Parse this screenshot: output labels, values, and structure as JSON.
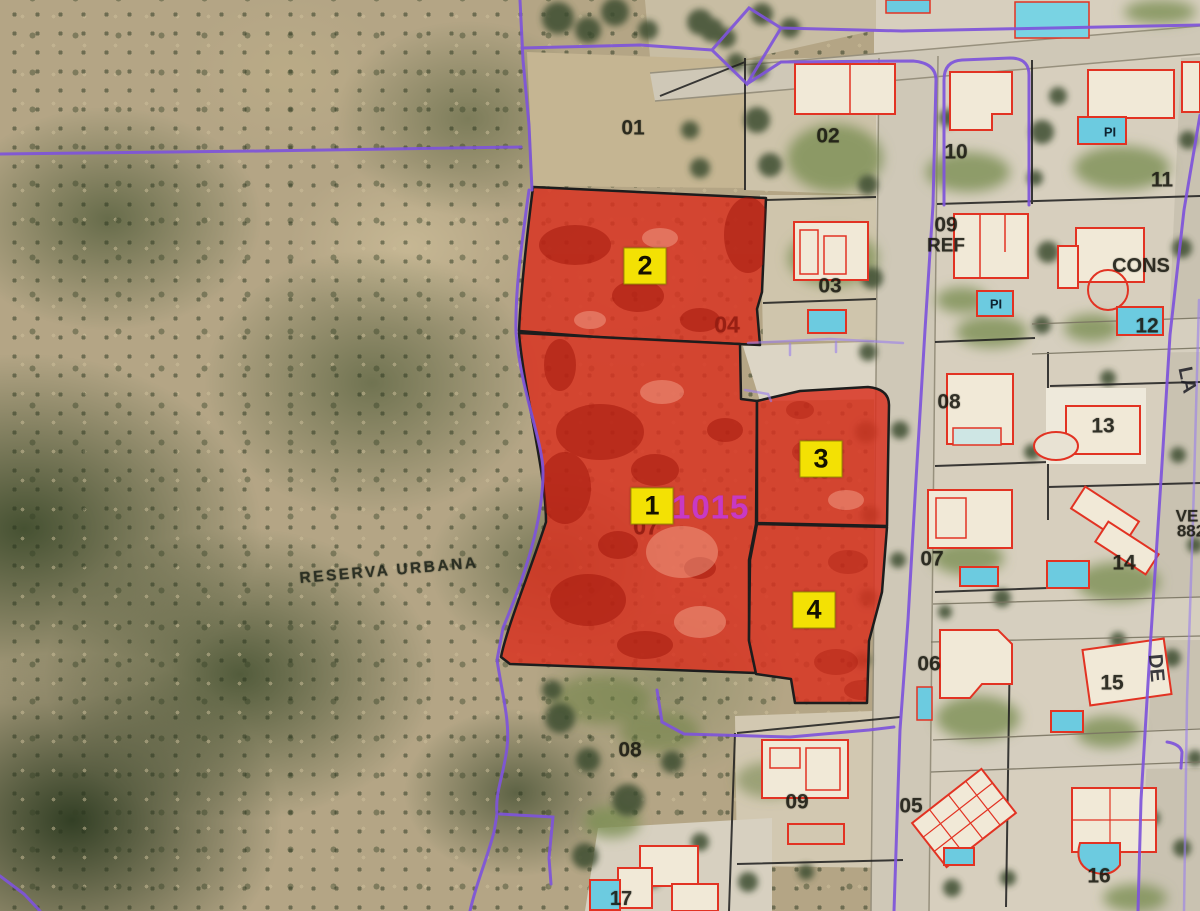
{
  "map": {
    "description": "Aerial cadastral map with red highlighted parcels",
    "colors": {
      "highlight_fill": "#d43322",
      "badge_bg": "#f2e10c",
      "boundary_purple": "#7d55d6",
      "building_outline": "#dd3425",
      "ref_magenta": "#c43bbf",
      "sub_label_dark_red": "#8e1d12"
    },
    "area_label": {
      "text": "RESERVA URBANA",
      "x": 389,
      "y": 571,
      "rotation": -5
    },
    "ref_label": {
      "text": "31015",
      "x": 701,
      "y": 507
    },
    "parcel_badges": [
      {
        "id": "2",
        "x": 645,
        "y": 266
      },
      {
        "id": "1",
        "x": 652,
        "y": 506
      },
      {
        "id": "3",
        "x": 821,
        "y": 459
      },
      {
        "id": "4",
        "x": 814,
        "y": 610
      }
    ],
    "sub_parcel_labels": [
      {
        "text": "04",
        "x": 727,
        "y": 325
      },
      {
        "text": "07",
        "x": 646,
        "y": 527
      },
      {
        "text": "05",
        "x": 820,
        "y": 473,
        "size": 17,
        "opacity": 0.55
      }
    ],
    "plot_numbers": [
      {
        "text": "01",
        "x": 633,
        "y": 128
      },
      {
        "text": "02",
        "x": 828,
        "y": 136
      },
      {
        "text": "03",
        "x": 830,
        "y": 286
      },
      {
        "text": "10",
        "x": 956,
        "y": 152
      },
      {
        "text": "11",
        "x": 1162,
        "y": 180
      },
      {
        "text": "09",
        "x": 946,
        "y": 225
      },
      {
        "text": "REF",
        "x": 946,
        "y": 246,
        "size": 19
      },
      {
        "text": "CONS",
        "x": 1141,
        "y": 266,
        "size": 20
      },
      {
        "text": "12",
        "x": 1147,
        "y": 326
      },
      {
        "text": "13",
        "x": 1103,
        "y": 426
      },
      {
        "text": "08",
        "x": 949,
        "y": 402
      },
      {
        "text": "07",
        "x": 932,
        "y": 559
      },
      {
        "text": "14",
        "x": 1124,
        "y": 563
      },
      {
        "text": "VE",
        "x": 1187,
        "y": 516,
        "size": 17
      },
      {
        "text": "882",
        "x": 1191,
        "y": 531,
        "size": 17
      },
      {
        "text": "06",
        "x": 929,
        "y": 664
      },
      {
        "text": "15",
        "x": 1112,
        "y": 683
      },
      {
        "text": "05",
        "x": 911,
        "y": 806
      },
      {
        "text": "16",
        "x": 1099,
        "y": 876
      },
      {
        "text": "08",
        "x": 630,
        "y": 750
      },
      {
        "text": "09",
        "x": 797,
        "y": 802
      },
      {
        "text": "17",
        "x": 621,
        "y": 899,
        "size": 20
      }
    ],
    "street_labels": [
      {
        "text": "LA",
        "x": 1187,
        "y": 380,
        "rotation": 78
      },
      {
        "text": "DE",
        "x": 1156,
        "y": 668,
        "rotation": 85
      }
    ],
    "pool_labels": [
      {
        "text": "PI",
        "x": 1110,
        "y": 132
      },
      {
        "text": "PI",
        "x": 996,
        "y": 304
      }
    ]
  }
}
